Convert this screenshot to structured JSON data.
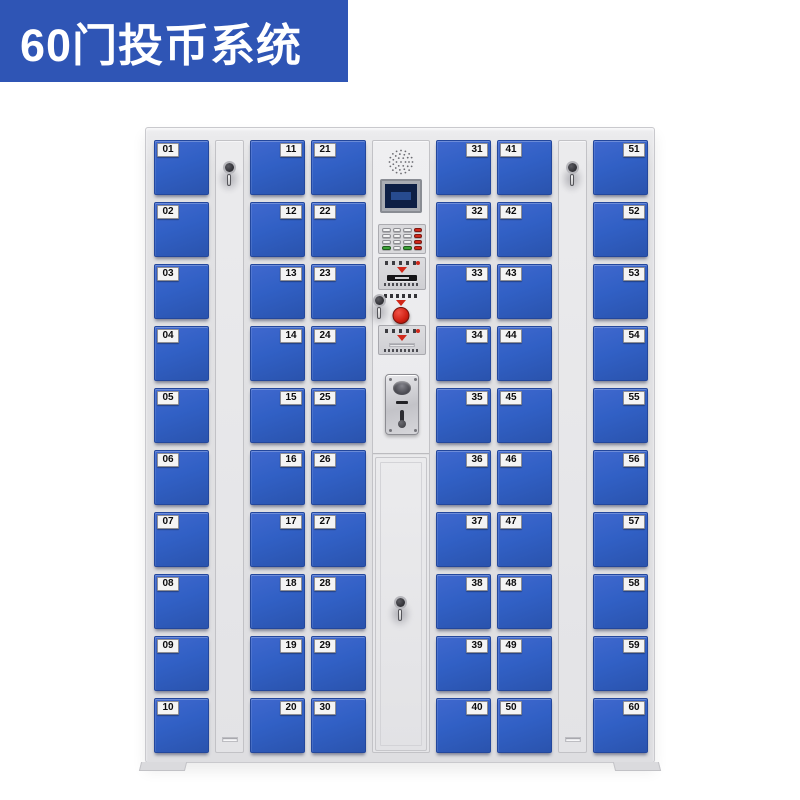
{
  "banner": {
    "title": "60门投币系统"
  },
  "colors": {
    "banner_bg": "#2f55b5",
    "door_blue": "#3160c5",
    "cabinet_gray": "#e2e2e4",
    "accent_red": "#d1281a",
    "accent_green": "#3fa339",
    "screen_navy": "#0d1f45"
  },
  "locker": {
    "door_count": 60,
    "columns": [
      {
        "type": "doors",
        "label_side": "left",
        "doors": [
          "01",
          "02",
          "03",
          "04",
          "05",
          "06",
          "07",
          "08",
          "09",
          "10"
        ]
      },
      {
        "type": "lock_strip"
      },
      {
        "type": "doors",
        "label_side": "right",
        "doors": [
          "11",
          "12",
          "13",
          "14",
          "15",
          "16",
          "17",
          "18",
          "19",
          "20"
        ]
      },
      {
        "type": "doors",
        "label_side": "left",
        "doors": [
          "21",
          "22",
          "23",
          "24",
          "25",
          "26",
          "27",
          "28",
          "29",
          "30"
        ]
      },
      {
        "type": "control_panel"
      },
      {
        "type": "doors",
        "label_side": "right",
        "doors": [
          "31",
          "32",
          "33",
          "34",
          "35",
          "36",
          "37",
          "38",
          "39",
          "40"
        ]
      },
      {
        "type": "doors",
        "label_side": "left",
        "doors": [
          "41",
          "42",
          "43",
          "44",
          "45",
          "46",
          "47",
          "48",
          "49",
          "50"
        ]
      },
      {
        "type": "lock_strip"
      },
      {
        "type": "doors",
        "label_side": "right",
        "doors": [
          "51",
          "52",
          "53",
          "54",
          "55",
          "56",
          "57",
          "58",
          "59",
          "60"
        ]
      }
    ]
  },
  "control_panel": {
    "components": [
      "speaker-grille",
      "display-screen",
      "keypad",
      "card-reader",
      "emergency-button",
      "master-key-lock",
      "ticket-dispenser",
      "coin-acceptor",
      "service-door"
    ]
  }
}
